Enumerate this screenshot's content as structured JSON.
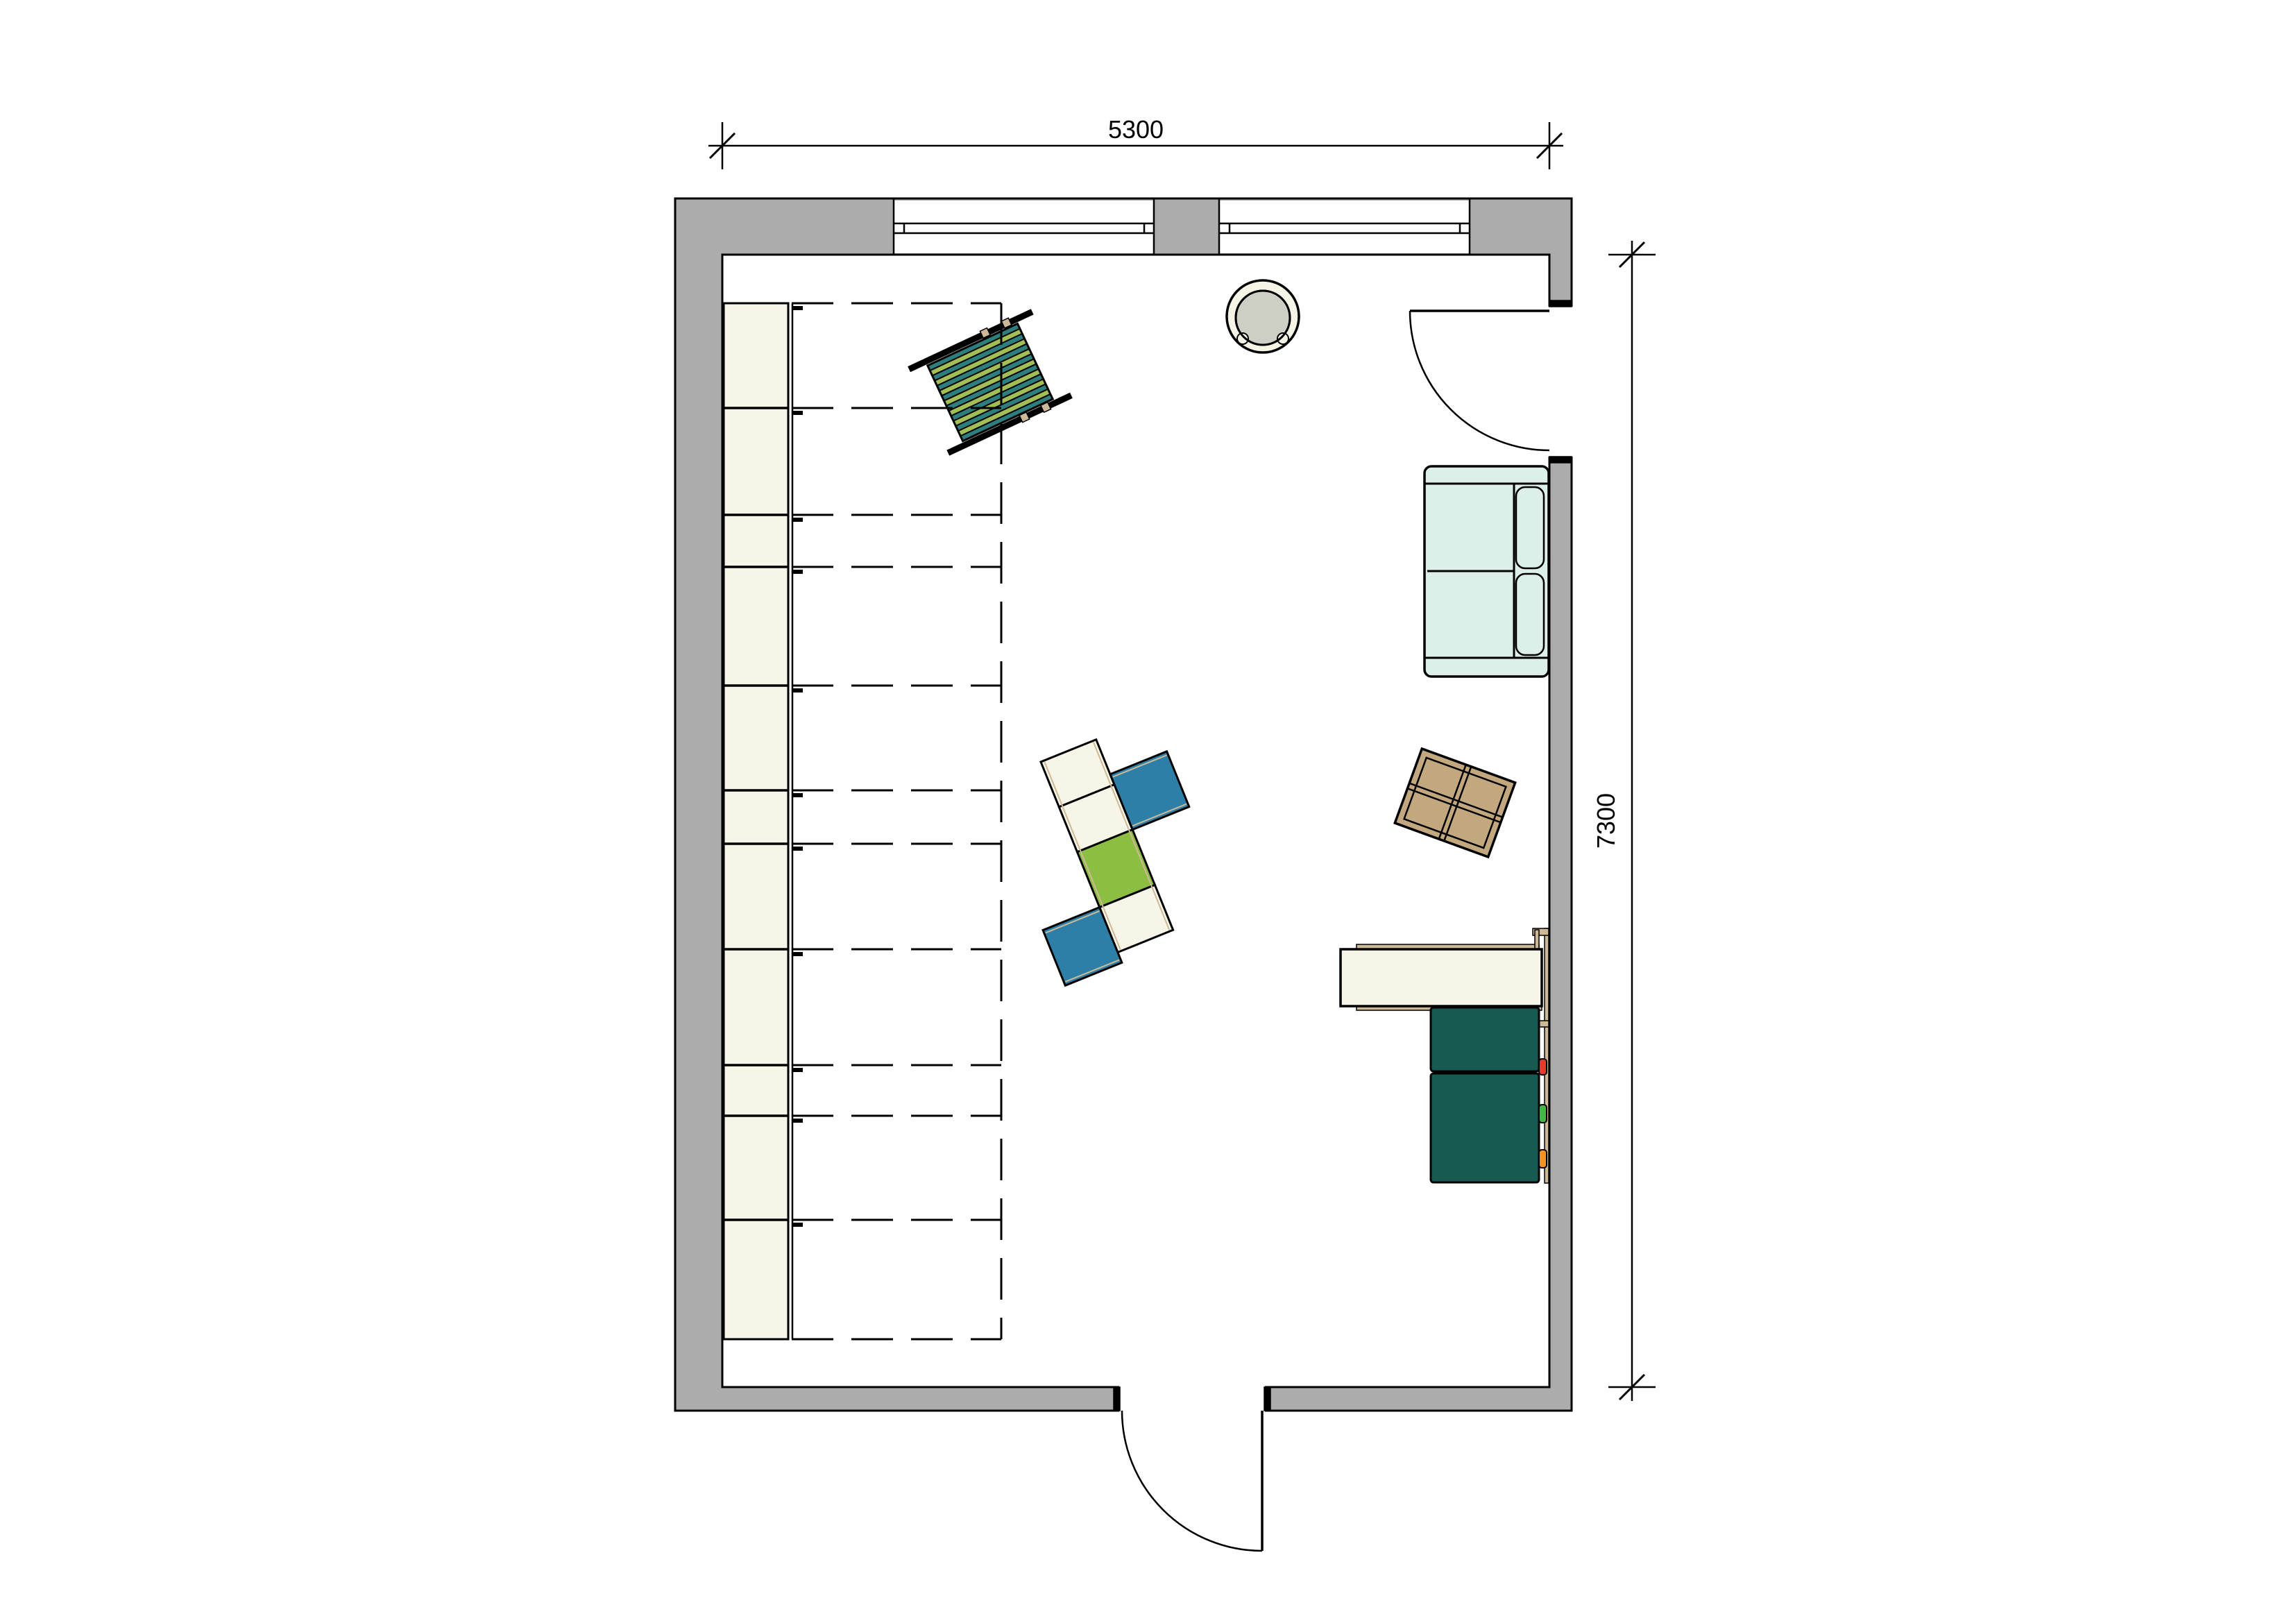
{
  "dimension_width": {
    "label": "5300"
  },
  "dimension_height": {
    "label": "7300"
  },
  "colors": {
    "wall": "#ACACAC",
    "cream": "#F7F5E8",
    "mint": "#DCF0E9",
    "teal": "#175A52",
    "blue": "#2D7FA8",
    "applegreen": "#8DBE44",
    "loungerteal": "#2F7E7E",
    "loungergreen": "#A2BE55",
    "wood": "#CDB997",
    "woodtable": "#C3A77F",
    "stoolgray": "#CDCFC5",
    "stoolcream": "#F6F3E7",
    "knobred": "#E63A2E",
    "knobgreen": "#3FBA49",
    "knoborange": "#F59120"
  },
  "rooms": {
    "main_room": "playroom-floor-plan"
  },
  "architecture": [
    "top-window-left",
    "top-window-right",
    "window-pier",
    "door-right",
    "door-bottom"
  ],
  "furniture": [
    "wardrobe-cabinet",
    "stacked-beds-outline",
    "striped-lounger",
    "round-stool",
    "sofa",
    "activity-tables",
    "square-play-table",
    "desk-unit"
  ]
}
